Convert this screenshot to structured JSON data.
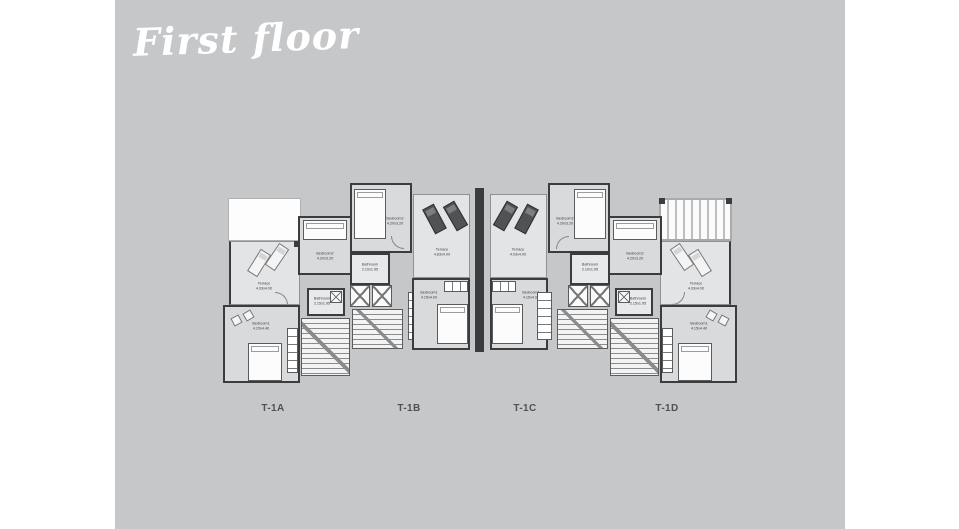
{
  "title": "First floor",
  "colors": {
    "canvas_bg": "#c6c7c9",
    "wall": "#3b3c3e",
    "room_fill": "#d9dadc",
    "terrace_fill": "#e3e4e5",
    "label_text": "#505155"
  },
  "units": [
    {
      "label": "T-1A",
      "rooms": [
        {
          "name": "Terrace",
          "dim": "4.03x4.00"
        },
        {
          "name": "Bedroom2",
          "dim": "4.20x3.20"
        },
        {
          "name": "Bathroom",
          "dim": "2.15x1.95"
        },
        {
          "name": "Bedroom1",
          "dim": "4.15x4.40"
        }
      ]
    },
    {
      "label": "T-1B",
      "rooms": [
        {
          "name": "Bedroom2",
          "dim": "4.20x3.20"
        },
        {
          "name": "Bathroom",
          "dim": "2.10x1.95"
        },
        {
          "name": "Terrace",
          "dim": "4.83x4.00"
        },
        {
          "name": "Bedroom1",
          "dim": "4.15x4.00"
        }
      ]
    },
    {
      "label": "T-1C",
      "rooms": [
        {
          "name": "Bedroom2",
          "dim": "4.20x3.20"
        },
        {
          "name": "Bathroom",
          "dim": "2.10x1.95"
        },
        {
          "name": "Terrace",
          "dim": "4.03x4.00"
        },
        {
          "name": "Bedroom1",
          "dim": "4.15x4.00"
        }
      ]
    },
    {
      "label": "T-1D",
      "rooms": [
        {
          "name": "Terrace",
          "dim": "4.03x4.00"
        },
        {
          "name": "Bedroom2",
          "dim": "4.20x3.20"
        },
        {
          "name": "Bathroom",
          "dim": "2.15x1.95"
        },
        {
          "name": "Bedroom1",
          "dim": "4.15x4.40"
        }
      ]
    }
  ]
}
